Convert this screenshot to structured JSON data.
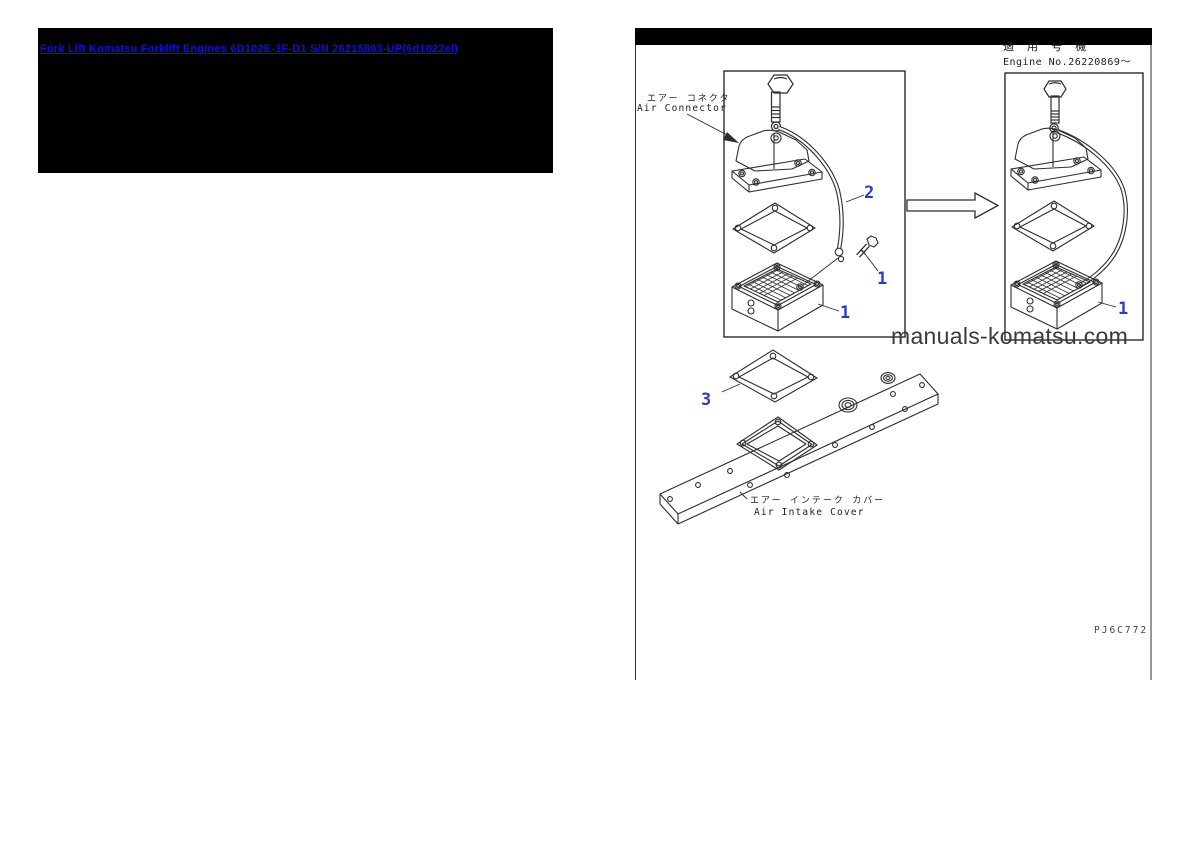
{
  "banner": {
    "link_text": "Fork Lift Komatsu Forklift Engines 6D102E-1F-D1 S/N 26215803-UP(6d1022el)"
  },
  "sheet": {
    "applicability_jp": "適 用 号 機",
    "engine_no": "Engine No.26220869～",
    "air_connector_jp": "エアー コネクタ",
    "air_connector_en": "Air Connector",
    "air_intake_cover_jp": "エアー インテーク カバー",
    "air_intake_cover_en": "Air Intake Cover",
    "watermark": "manuals-komatsu.com",
    "drawing_code": "PJ6C772",
    "callouts": [
      {
        "part": "tube-clip-bolt",
        "n": "2"
      },
      {
        "part": "connector-bolt",
        "n": "1"
      },
      {
        "part": "heater-box-left",
        "n": "1"
      },
      {
        "part": "heater-box-right",
        "n": "1"
      },
      {
        "part": "cover-gasket",
        "n": "3"
      }
    ],
    "colors": {
      "callout_blue": "#2a3bd0",
      "link_blue": "#0d0de8"
    }
  }
}
